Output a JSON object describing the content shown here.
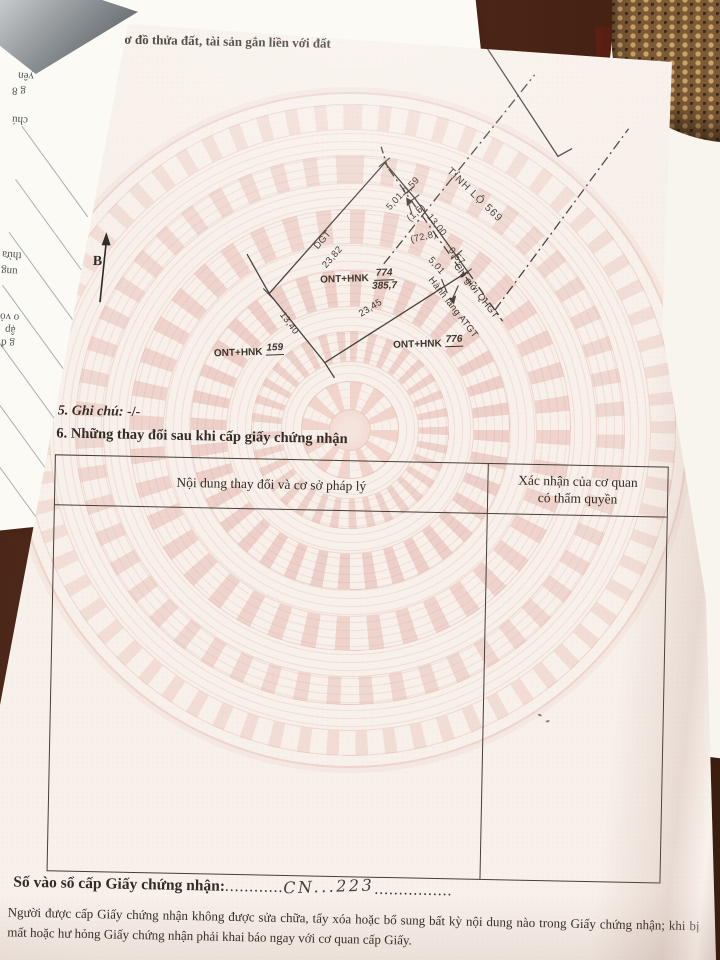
{
  "document": {
    "section4_title": "4. Sơ đồ thửa đất, tài sản gắn liền với đất",
    "section5_label": "5. Ghi chú:",
    "section5_value": "-/-",
    "section6_title": "6. Những thay đổi sau khi cấp giấy chứng nhận",
    "registry_label": "Số vào sổ cấp Giấy chứng nhận:",
    "registry_dots_before": "............",
    "registry_number": "CN...223",
    "registry_dots_after": "................",
    "footer_text": "Người được cấp Giấy chứng nhận không được sửa chữa, tẩy xóa hoặc bổ sung bất kỳ nội dung nào trong Giấy chứng nhận; khi bị mất hoặc hư hỏng Giấy chứng nhận phải khai báo ngay với cơ quan cấp Giấy."
  },
  "table": {
    "col1_header": "Nội dung thay đổi và cơ sở pháp lý",
    "col2_header_line1": "Xác nhận của cơ quan",
    "col2_header_line2": "có thẩm quyền"
  },
  "diagram": {
    "north": "B",
    "road": "TỈNH LỘ 569",
    "dgt": "DGT",
    "m_2382": "23,82",
    "m_501a": "5,01",
    "m_059": "0,59",
    "m_15": "(1,5)",
    "m_1300": "13,00",
    "m_728": "(72,8)",
    "m_057": "0,57",
    "m_501b": "5,01",
    "m_2345": "23,45",
    "m_1340": "13,40",
    "qhgt": "Chỉ giới QHGT",
    "atgt": "Hành lang ATGT",
    "p774_use": "ONT+HNK",
    "p774_no": "774",
    "p774_area": "385,7",
    "p159_use": "ONT+HNK",
    "p159_no": "159",
    "p776_use": "ONT+HNK",
    "p776_no": "776"
  },
  "underpage": {
    "fragments": [
      "uệ",
      "yên",
      "g 8",
      "chú",
      "thừa",
      "ung",
      "o vỏ",
      "ập",
      "g đ"
    ]
  },
  "colors": {
    "page": "#f8f0ea",
    "ink": "#332c25",
    "watermark_pink": "#ecc4bb",
    "wood": "#4a2718"
  }
}
